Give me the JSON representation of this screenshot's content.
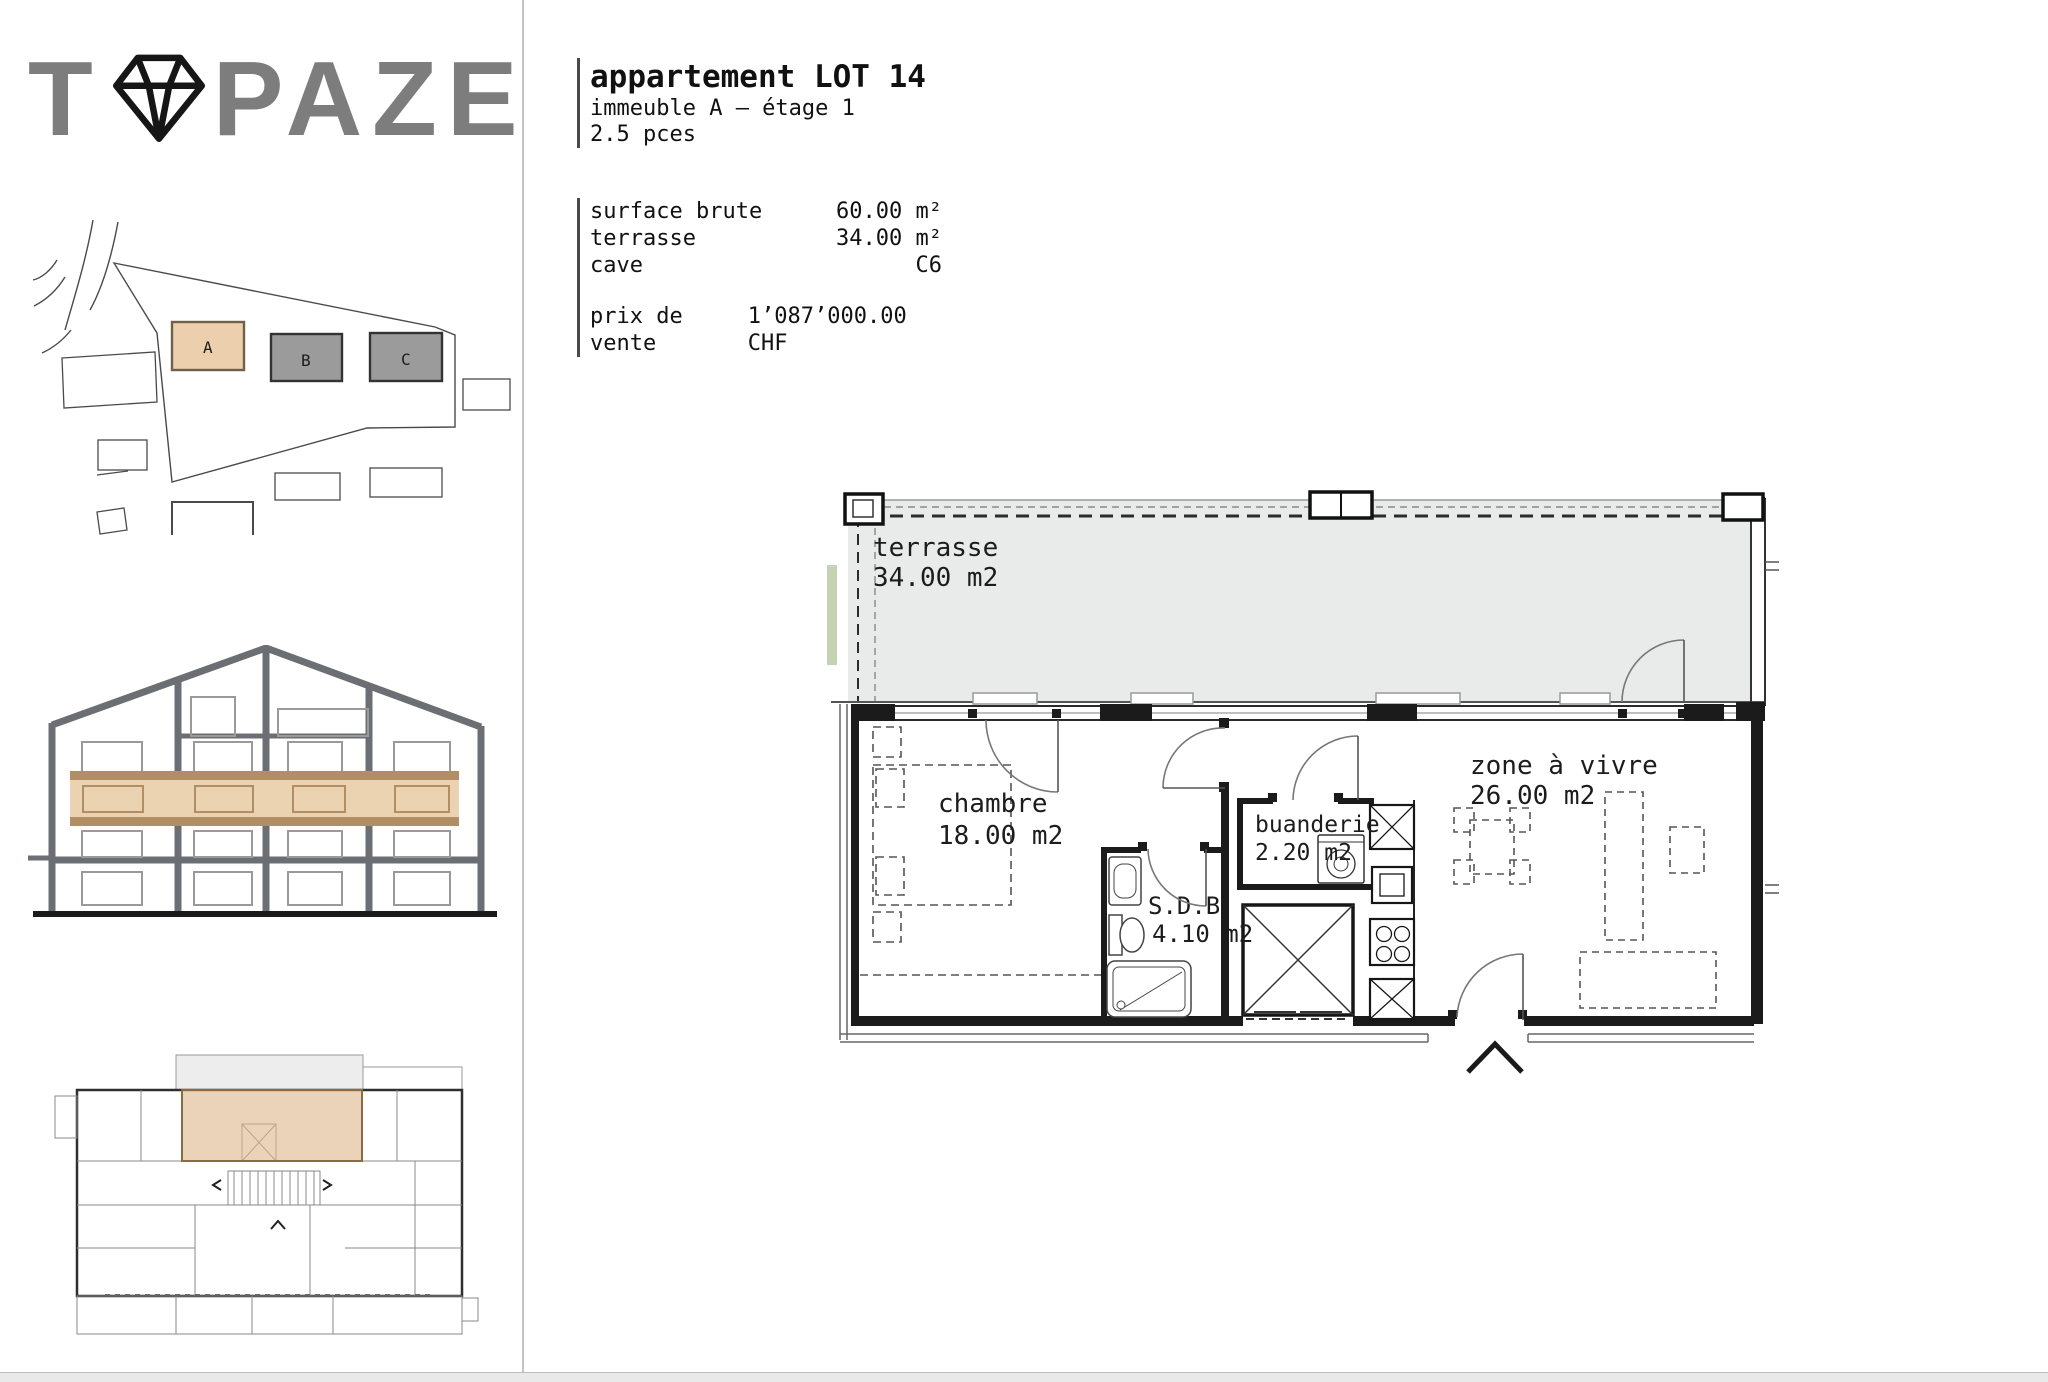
{
  "brand": {
    "name": "TOPAZE",
    "prefix": "T",
    "suffix": "PAZE",
    "diamond_icon": "diamond-gem-icon"
  },
  "site_plan": {
    "buildings": [
      {
        "label": "A",
        "highlighted": true
      },
      {
        "label": "B",
        "highlighted": false
      },
      {
        "label": "C",
        "highlighted": false
      }
    ]
  },
  "header": {
    "title": "appartement LOT 14",
    "building_line": "immeuble A – étage 1",
    "rooms_line": "2.5 pces"
  },
  "details": {
    "rows": [
      {
        "label": "surface brute",
        "value": "60.00 m²"
      },
      {
        "label": "terrasse",
        "value": "34.00 m²"
      },
      {
        "label": "cave",
        "value": "C6"
      }
    ],
    "price_label": "prix de vente",
    "price_value": "1’087’000.00 CHF"
  },
  "floor_plan": {
    "terrasse": {
      "name": "terrasse",
      "area": "34.00 m2"
    },
    "chambre": {
      "name": "chambre",
      "area": "18.00 m2"
    },
    "buanderie": {
      "name": "buanderie",
      "area": "2.20 m2"
    },
    "sdb": {
      "name": "S.D.B",
      "area": "4.10 m2"
    },
    "zone_a_vivre": {
      "name": "zone à vivre",
      "area": "26.00 m2"
    }
  },
  "colors": {
    "highlight_tan": "#e8cba6",
    "tan_border": "#b18e63",
    "building_gray": "#9b9b9b",
    "terrace_gray": "#e9ebeb",
    "structure_gray": "#6b6f74",
    "garden_green": "#c6d2b4"
  }
}
